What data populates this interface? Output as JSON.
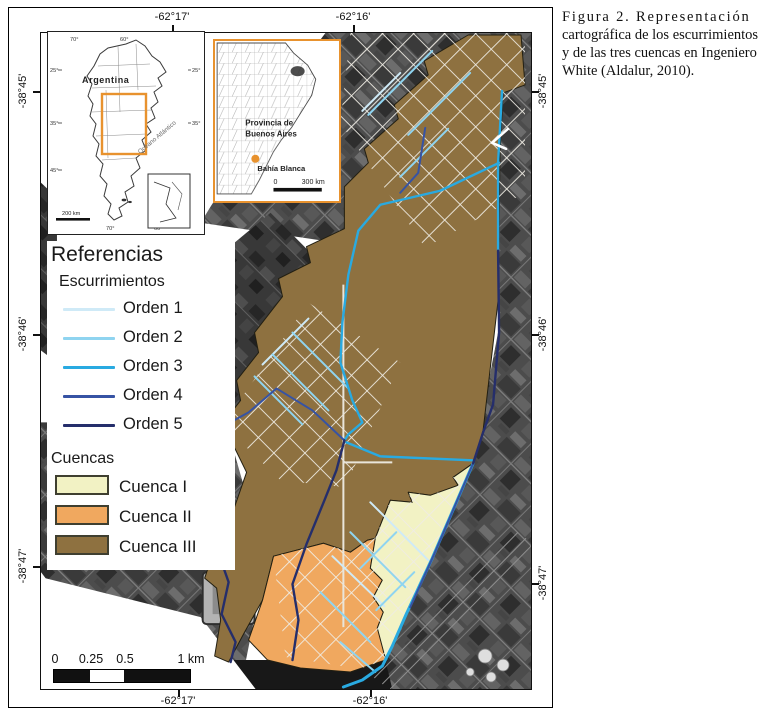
{
  "caption": {
    "lines": [
      "Figura 2. Representación",
      "cartográfica de los escurrimientos",
      "y de las tres cuencas en Ingeniero",
      "White (Aldalur, 2010)."
    ]
  },
  "axis": {
    "top": [
      "-62°17'",
      "-62°16'"
    ],
    "bottom": [
      "-62°17'",
      "-62°16'"
    ],
    "left": [
      "-38°45'",
      "-38°46'",
      "-38°47'"
    ],
    "right": [
      "-38°45'",
      "-38°46'",
      "-38°47'"
    ]
  },
  "legend": {
    "title": "Referencias",
    "streams_heading": "Escurrimientos",
    "orders": [
      {
        "label": "Orden 1",
        "color": "#cfeaf7"
      },
      {
        "label": "Orden 2",
        "color": "#8fd4f0"
      },
      {
        "label": "Orden 3",
        "color": "#29aae1"
      },
      {
        "label": "Orden 4",
        "color": "#3653a4"
      },
      {
        "label": "Orden 5",
        "color": "#252e6b"
      }
    ],
    "basins_heading": "Cuencas",
    "basins": [
      {
        "label": "Cuenca I",
        "color": "#f2f2c4"
      },
      {
        "label": "Cuenca II",
        "color": "#f0a85f"
      },
      {
        "label": "Cuenca III",
        "color": "#8e7140"
      }
    ]
  },
  "inset_argentina": {
    "country": "Argentina",
    "ocean": "Océano Atlántico",
    "scale": "200 km",
    "ticks_top": [
      "70°",
      "60°"
    ],
    "ticks_bottom": [
      "70°",
      "60°"
    ],
    "ticks_left": [
      "25°",
      "35°",
      "45°"
    ],
    "ticks_right": [
      "25°",
      "35°"
    ]
  },
  "inset_buenos_aires": {
    "province_line1": "Provincia de",
    "province_line2": "Buenos Aires",
    "city": "Bahía Blanca",
    "scale_start": "0",
    "scale_end": "300 km"
  },
  "scalebar": {
    "labels": [
      "0",
      "0.25",
      "0.5",
      "1 km"
    ]
  }
}
